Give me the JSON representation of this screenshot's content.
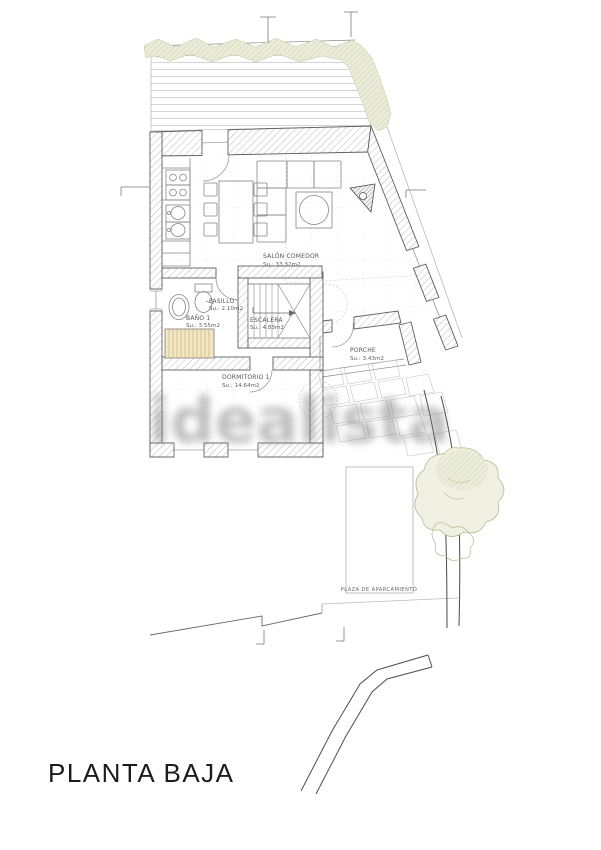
{
  "plan": {
    "title": "PLANTA BAJA",
    "watermark": "idealista",
    "labels": {
      "salon": {
        "name": "SALÓN COMEDOR",
        "area": "Su.: 33.32m2"
      },
      "pasillo": {
        "name": "PASILLO",
        "area": "Su.: 2.10m2"
      },
      "bano": {
        "name": "BAÑO 1",
        "area": "Su.: 3.55m2"
      },
      "escalera": {
        "name": "ESCALERA",
        "area": "Su.: 4.83m2"
      },
      "dormitorio": {
        "name": "DORMITORIO 1",
        "area": "Su.: 14.64m2"
      },
      "porche": {
        "name": "PORCHE",
        "area": "Su.: 3.43m2"
      },
      "parking": {
        "name": "PLAZA DE APARCAMIENTO"
      }
    },
    "colors": {
      "wall_line": "#5d5d5d",
      "hedge_green": "#c6c9a0",
      "closet_tan": "#f1e7c4",
      "label_gray": "#565656",
      "watermark_gray": "#7f7f7f"
    }
  }
}
